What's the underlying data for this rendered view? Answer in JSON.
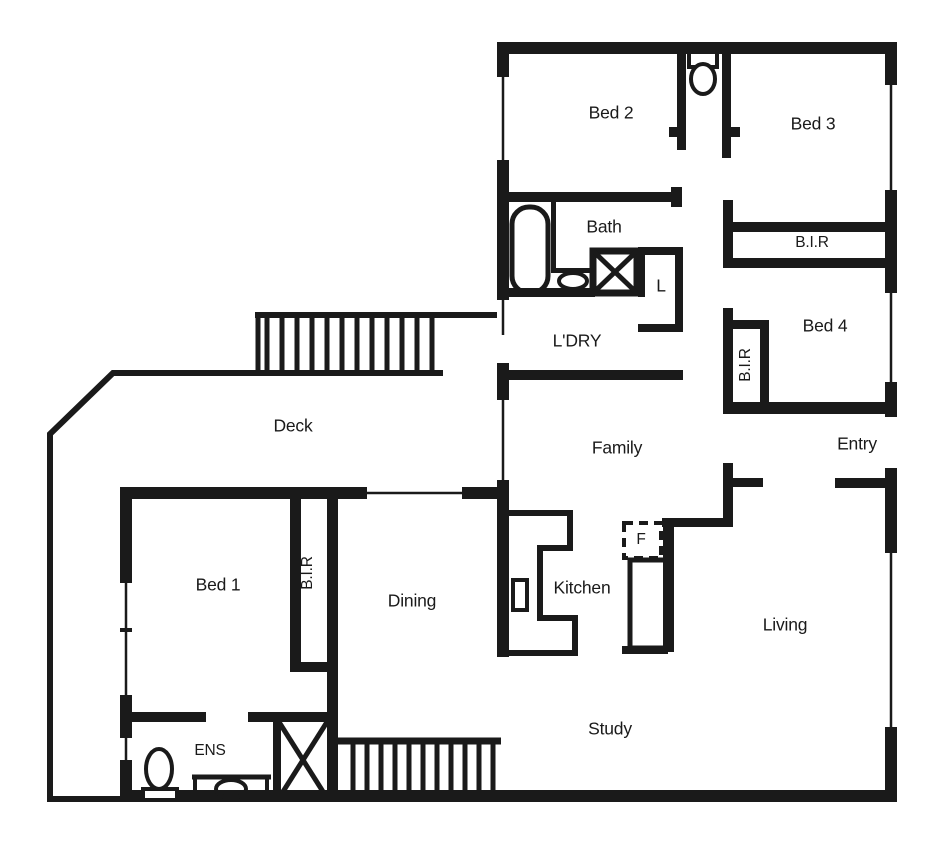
{
  "canvas": {
    "width": 949,
    "height": 853,
    "background": "#ffffff",
    "wall_color": "#1a1a1a"
  },
  "rooms": {
    "bed1": "Bed 1",
    "bed2": "Bed 2",
    "bed3": "Bed 3",
    "bed4": "Bed 4",
    "bath": "Bath",
    "ens": "ENS",
    "ldry": "L'DRY",
    "linen": "L",
    "bir_bed3": "B.I.R",
    "bir_bed4": "B.I.R",
    "bir_bed1": "B.I.R",
    "deck": "Deck",
    "family": "Family",
    "entry": "Entry",
    "dining": "Dining",
    "kitchen": "Kitchen",
    "living": "Living",
    "study": "Study",
    "fridge": "F"
  },
  "fixtures": [
    "bathtub",
    "vanity-basin-bath",
    "shower-bath",
    "toilet-wc",
    "toilet-ens",
    "vanity-basin-ens",
    "shower-ens",
    "kitchen-bench",
    "island-bench",
    "fridge-space",
    "deck-stairs",
    "internal-stairs",
    "windows"
  ]
}
